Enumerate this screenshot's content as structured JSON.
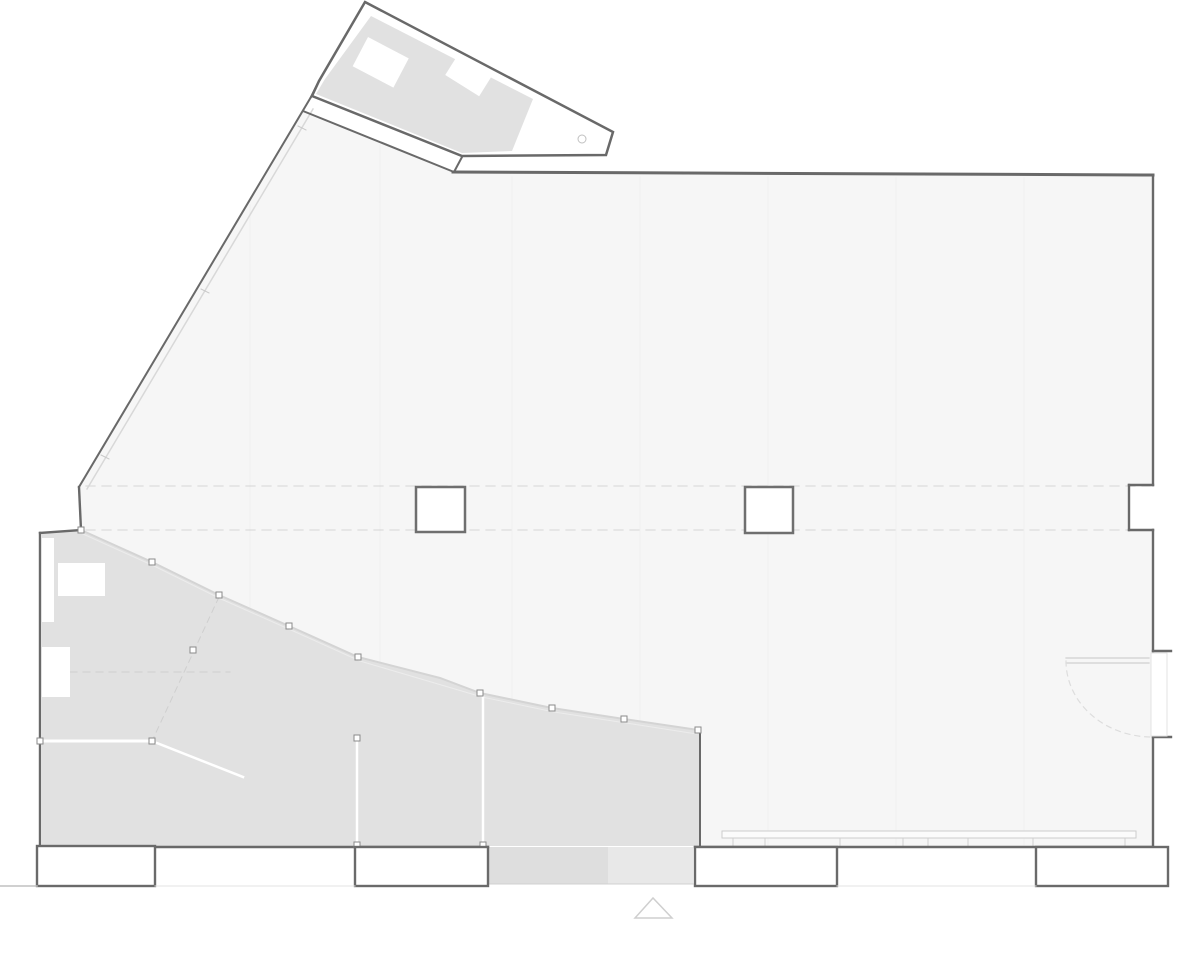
{
  "document": {
    "type": "architectural-floor-plan",
    "visible_text": [],
    "palette": {
      "background": "#ffffff",
      "hall_floor": "#f6f6f6",
      "studio_floor": "#e1e1e1",
      "wall_line": "#696969",
      "glazing_line": "#d4d4d4",
      "axis_dash": "#dcdcdc"
    }
  },
  "plan": {
    "width": 1200,
    "height": 978,
    "layers": [
      {
        "name": "hall-floor",
        "items": [
          {
            "t": "polygon",
            "pts": "303,111 454,172 1153,175 1153,485 1129,485 1129,530 1153,530 1153,847 701,847 701,731 624,719 552,708 480,693 440,678 358,657 289,626 219,595 152,562 81,530 79,487",
            "fill": "#f6f6f6"
          }
        ]
      },
      {
        "name": "studio-floor",
        "items": [
          {
            "t": "polygon",
            "pts": "42,533 81,531 152,562 219,595 289,626 358,657 440,678 480,693 552,708 624,719 699,731 699,846 42,846",
            "fill": "#e1e1e1"
          }
        ]
      },
      {
        "name": "entry-ramp",
        "items": [
          {
            "t": "rect",
            "x": 488,
            "y": 847,
            "w": 120,
            "h": 37,
            "fill": "#dedede"
          },
          {
            "t": "rect",
            "x": 608,
            "y": 847,
            "w": 85,
            "h": 37,
            "fill": "#e8e8e8"
          },
          {
            "t": "line",
            "x1": 488,
            "y1": 884,
            "x2": 693,
            "y2": 884,
            "stroke": "#d0d0d0",
            "sw": 1
          }
        ]
      },
      {
        "name": "floor-board-lines",
        "stroke": "#f0f0f0",
        "sw": 1,
        "items": [
          {
            "t": "line",
            "x1": 250,
            "y1": 205,
            "x2": 250,
            "y2": 607
          },
          {
            "t": "line",
            "x1": 380,
            "y1": 145,
            "x2": 380,
            "y2": 663
          },
          {
            "t": "line",
            "x1": 512,
            "y1": 177,
            "x2": 512,
            "y2": 700
          },
          {
            "t": "line",
            "x1": 640,
            "y1": 177,
            "x2": 640,
            "y2": 721
          },
          {
            "t": "line",
            "x1": 768,
            "y1": 177,
            "x2": 768,
            "y2": 845
          },
          {
            "t": "line",
            "x1": 896,
            "y1": 178,
            "x2": 896,
            "y2": 845
          },
          {
            "t": "line",
            "x1": 1024,
            "y1": 178,
            "x2": 1024,
            "y2": 845
          }
        ]
      },
      {
        "name": "structural-axis-lines",
        "items": [
          {
            "t": "line",
            "x1": 86,
            "y1": 486,
            "x2": 1150,
            "y2": 486,
            "stroke": "#dcdcdc",
            "sw": 1.2,
            "dash": "9 7"
          },
          {
            "t": "line",
            "x1": 86,
            "y1": 530,
            "x2": 1150,
            "y2": 530,
            "stroke": "#dcdcdc",
            "sw": 1.2,
            "dash": "9 7"
          },
          {
            "t": "line",
            "x1": 44,
            "y1": 672,
            "x2": 230,
            "y2": 672,
            "stroke": "#cfcfcf",
            "sw": 1,
            "dash": "7 6"
          },
          {
            "t": "line",
            "x1": 219,
            "y1": 597,
            "x2": 153,
            "y2": 739,
            "stroke": "#cfcfcf",
            "sw": 1,
            "dash": "6 5"
          }
        ]
      },
      {
        "name": "glazing-diagonal-wall",
        "stroke": "#d8d8d8",
        "sw": 1.5,
        "items": [
          {
            "t": "line",
            "x1": 313,
            "y1": 109,
            "x2": 87,
            "y2": 489
          },
          {
            "t": "line",
            "x1": 298,
            "y1": 126,
            "x2": 306,
            "y2": 130,
            "stroke": "#c8c8c8",
            "sw": 1
          },
          {
            "t": "line",
            "x1": 201,
            "y1": 289,
            "x2": 209,
            "y2": 293,
            "stroke": "#c8c8c8",
            "sw": 1
          },
          {
            "t": "line",
            "x1": 101,
            "y1": 455,
            "x2": 109,
            "y2": 459,
            "stroke": "#c8c8c8",
            "sw": 1
          }
        ]
      },
      {
        "name": "glazing-boundary",
        "items": [
          {
            "t": "polyline",
            "pts": "81,530 152,562 219,595 289,626 358,657 440,678 480,693 552,708 624,719 698,730",
            "stroke": "#d4d4d4",
            "sw": 2
          },
          {
            "t": "polyline",
            "pts": "83,534 154,566 221,599 291,630 360,661 482,697 554,712 626,723 697,734",
            "stroke": "#ececec",
            "sw": 1
          }
        ]
      },
      {
        "name": "interior-partitions",
        "stroke": "#ffffff",
        "items": [
          {
            "t": "line",
            "x1": 44,
            "y1": 741,
            "x2": 150,
            "y2": 741,
            "sw": 3
          },
          {
            "t": "line",
            "x1": 357,
            "y1": 740,
            "x2": 357,
            "y2": 844,
            "sw": 2.5
          },
          {
            "t": "line",
            "x1": 483,
            "y1": 697,
            "x2": 483,
            "y2": 844,
            "sw": 2.5
          },
          {
            "t": "line",
            "x1": 157,
            "y1": 743,
            "x2": 243,
            "y2": 777,
            "sw": 2.5
          }
        ]
      },
      {
        "name": "furniture",
        "fill": "#ffffff",
        "items": [
          {
            "t": "rect",
            "x": 58,
            "y": 563,
            "w": 47,
            "h": 33
          },
          {
            "t": "rect",
            "x": 42,
            "y": 647,
            "w": 28,
            "h": 50
          },
          {
            "t": "rect",
            "x": 41,
            "y": 538,
            "w": 13,
            "h": 84
          }
        ]
      },
      {
        "name": "annex-wing",
        "items": [
          {
            "t": "polygon",
            "pts": "365,2 613,132 606,155 462,156 312,96 319,81",
            "fill": "#ffffff",
            "stroke": "#696969",
            "sw": 2.5
          },
          {
            "t": "polygon",
            "pts": "371,16 533,99 512,151 462,153 316,94 325,79",
            "fill": "#e1e1e1"
          },
          {
            "t": "rect",
            "x": 368,
            "y": 37,
            "w": 46,
            "h": 33,
            "fill": "#ffffff",
            "transform": "rotate(27.7 368 37)"
          },
          {
            "t": "rect",
            "x": 459,
            "y": 53,
            "w": 40,
            "h": 26,
            "fill": "#ffffff",
            "transform": "rotate(32 459 53)"
          },
          {
            "t": "circle",
            "cx": 582,
            "cy": 139,
            "r": 4,
            "fill": "#ffffff",
            "stroke": "#c0c0c0",
            "sw": 1
          }
        ]
      },
      {
        "name": "window-bench",
        "items": [
          {
            "t": "rect",
            "x": 722,
            "y": 831,
            "w": 414,
            "h": 7,
            "fill": "#fbfbfb",
            "stroke": "#cccccc",
            "sw": 1
          },
          {
            "t": "line",
            "x1": 733,
            "y1": 838,
            "x2": 733,
            "y2": 846,
            "stroke": "#d0d0d0",
            "sw": 1
          },
          {
            "t": "line",
            "x1": 765,
            "y1": 838,
            "x2": 765,
            "y2": 846,
            "stroke": "#d0d0d0",
            "sw": 1
          },
          {
            "t": "line",
            "x1": 840,
            "y1": 838,
            "x2": 840,
            "y2": 846,
            "stroke": "#d0d0d0",
            "sw": 1
          },
          {
            "t": "line",
            "x1": 903,
            "y1": 838,
            "x2": 903,
            "y2": 846,
            "stroke": "#d0d0d0",
            "sw": 1
          },
          {
            "t": "line",
            "x1": 928,
            "y1": 838,
            "x2": 928,
            "y2": 846,
            "stroke": "#d0d0d0",
            "sw": 1
          },
          {
            "t": "line",
            "x1": 968,
            "y1": 838,
            "x2": 968,
            "y2": 846,
            "stroke": "#d0d0d0",
            "sw": 1
          },
          {
            "t": "line",
            "x1": 1033,
            "y1": 838,
            "x2": 1033,
            "y2": 846,
            "stroke": "#d0d0d0",
            "sw": 1
          },
          {
            "t": "line",
            "x1": 1125,
            "y1": 838,
            "x2": 1125,
            "y2": 846,
            "stroke": "#d0d0d0",
            "sw": 1
          }
        ]
      },
      {
        "name": "walls",
        "stroke": "#696969",
        "sw": 2.4,
        "items": [
          {
            "t": "line",
            "x1": 453,
            "y1": 172,
            "x2": 1153,
            "y2": 175,
            "sw": 3
          },
          {
            "t": "line",
            "x1": 1153,
            "y1": 175,
            "x2": 1153,
            "y2": 485
          },
          {
            "t": "line",
            "x1": 1153,
            "y1": 485,
            "x2": 1129,
            "y2": 485
          },
          {
            "t": "line",
            "x1": 1129,
            "y1": 485,
            "x2": 1129,
            "y2": 530
          },
          {
            "t": "line",
            "x1": 1129,
            "y1": 530,
            "x2": 1153,
            "y2": 530
          },
          {
            "t": "line",
            "x1": 1153,
            "y1": 530,
            "x2": 1153,
            "y2": 651
          },
          {
            "t": "line",
            "x1": 1153,
            "y1": 737,
            "x2": 1153,
            "y2": 847
          },
          {
            "t": "line",
            "x1": 1153,
            "y1": 651,
            "x2": 1171,
            "y2": 651
          },
          {
            "t": "line",
            "x1": 1153,
            "y1": 737,
            "x2": 1171,
            "y2": 737
          },
          {
            "t": "line",
            "x1": 1153,
            "y1": 847,
            "x2": 695,
            "y2": 847
          },
          {
            "t": "line",
            "x1": 488,
            "y1": 847,
            "x2": 42,
            "y2": 847
          },
          {
            "t": "line",
            "x1": 40,
            "y1": 847,
            "x2": 40,
            "y2": 533
          },
          {
            "t": "line",
            "x1": 40,
            "y1": 533,
            "x2": 81,
            "y2": 530
          },
          {
            "t": "line",
            "x1": 81,
            "y1": 530,
            "x2": 79,
            "y2": 487
          },
          {
            "t": "line",
            "x1": 79,
            "y1": 487,
            "x2": 311,
            "y2": 97,
            "sw": 2
          },
          {
            "t": "line",
            "x1": 311,
            "y1": 97,
            "x2": 319,
            "y2": 81,
            "sw": 2
          },
          {
            "t": "line",
            "x1": 303,
            "y1": 111,
            "x2": 454,
            "y2": 172,
            "sw": 2
          },
          {
            "t": "line",
            "x1": 462,
            "y1": 157,
            "x2": 454,
            "y2": 172,
            "sw": 2
          },
          {
            "t": "line",
            "x1": 700,
            "y1": 731,
            "x2": 700,
            "y2": 847,
            "sw": 2
          }
        ]
      },
      {
        "name": "mullion-posts",
        "fill": "#ffffff",
        "stroke": "#8a8a8a",
        "sw": 1,
        "items": [
          {
            "t": "rect",
            "x": 78,
            "y": 527,
            "w": 6,
            "h": 6
          },
          {
            "t": "rect",
            "x": 149,
            "y": 559,
            "w": 6,
            "h": 6
          },
          {
            "t": "rect",
            "x": 216,
            "y": 592,
            "w": 6,
            "h": 6
          },
          {
            "t": "rect",
            "x": 286,
            "y": 623,
            "w": 6,
            "h": 6
          },
          {
            "t": "rect",
            "x": 355,
            "y": 654,
            "w": 6,
            "h": 6
          },
          {
            "t": "rect",
            "x": 477,
            "y": 690,
            "w": 6,
            "h": 6
          },
          {
            "t": "rect",
            "x": 549,
            "y": 705,
            "w": 6,
            "h": 6
          },
          {
            "t": "rect",
            "x": 621,
            "y": 716,
            "w": 6,
            "h": 6
          },
          {
            "t": "rect",
            "x": 695,
            "y": 727,
            "w": 6,
            "h": 6
          },
          {
            "t": "rect",
            "x": 190,
            "y": 647,
            "w": 6,
            "h": 6
          },
          {
            "t": "rect",
            "x": 37,
            "y": 738,
            "w": 6,
            "h": 6
          },
          {
            "t": "rect",
            "x": 149,
            "y": 738,
            "w": 6,
            "h": 6
          },
          {
            "t": "rect",
            "x": 354,
            "y": 735,
            "w": 6,
            "h": 6
          },
          {
            "t": "rect",
            "x": 354,
            "y": 842,
            "w": 6,
            "h": 6
          },
          {
            "t": "rect",
            "x": 480,
            "y": 842,
            "w": 6,
            "h": 6
          }
        ]
      },
      {
        "name": "entrance-door",
        "items": [
          {
            "t": "rect",
            "x": 1151,
            "y": 653,
            "w": 16,
            "h": 83,
            "fill": "#ffffff",
            "stroke": "#e3e3e3",
            "sw": 1
          },
          {
            "t": "line",
            "x1": 1066,
            "y1": 658,
            "x2": 1149,
            "y2": 658,
            "stroke": "#cfcfcf",
            "sw": 1.2
          },
          {
            "t": "line",
            "x1": 1066,
            "y1": 663,
            "x2": 1149,
            "y2": 663,
            "stroke": "#cfcfcf",
            "sw": 1.2
          },
          {
            "t": "path",
            "d": "M 1066 661 A 86 76 0 0 0 1152 737",
            "stroke": "#dddddd",
            "sw": 1.2,
            "dash": "5 5"
          }
        ]
      },
      {
        "name": "columns",
        "fill": "#ffffff",
        "stroke": "#6f6f6f",
        "sw": 2.5,
        "items": [
          {
            "t": "rect",
            "x": 416,
            "y": 487,
            "w": 49,
            "h": 45
          },
          {
            "t": "rect",
            "x": 745,
            "y": 487,
            "w": 48,
            "h": 46
          }
        ]
      },
      {
        "name": "exterior-stairs",
        "fill": "#ffffff",
        "stroke": "#6a6a6a",
        "sw": 2.4,
        "items": [
          {
            "t": "rect",
            "x": 37,
            "y": 846,
            "w": 118,
            "h": 40
          },
          {
            "t": "rect",
            "x": 355,
            "y": 847,
            "w": 133,
            "h": 39
          },
          {
            "t": "rect",
            "x": 695,
            "y": 847,
            "w": 142,
            "h": 39
          },
          {
            "t": "rect",
            "x": 1036,
            "y": 847,
            "w": 132,
            "h": 39
          },
          {
            "t": "line",
            "x1": 0,
            "y1": 886,
            "x2": 37,
            "y2": 886,
            "stroke": "#c0c0c0",
            "sw": 1.5
          },
          {
            "t": "line",
            "x1": 155,
            "y1": 886,
            "x2": 355,
            "y2": 886,
            "stroke": "#e3e3e3",
            "sw": 1
          },
          {
            "t": "line",
            "x1": 837,
            "y1": 886,
            "x2": 1036,
            "y2": 886,
            "stroke": "#e3e3e3",
            "sw": 1
          }
        ]
      },
      {
        "name": "entrance-marker",
        "items": [
          {
            "t": "path",
            "d": "M 635 918 L 672 918 L 653 898 Z",
            "fill": "#ffffff",
            "stroke": "#cfcfcf",
            "sw": 1.5
          }
        ]
      }
    ]
  }
}
